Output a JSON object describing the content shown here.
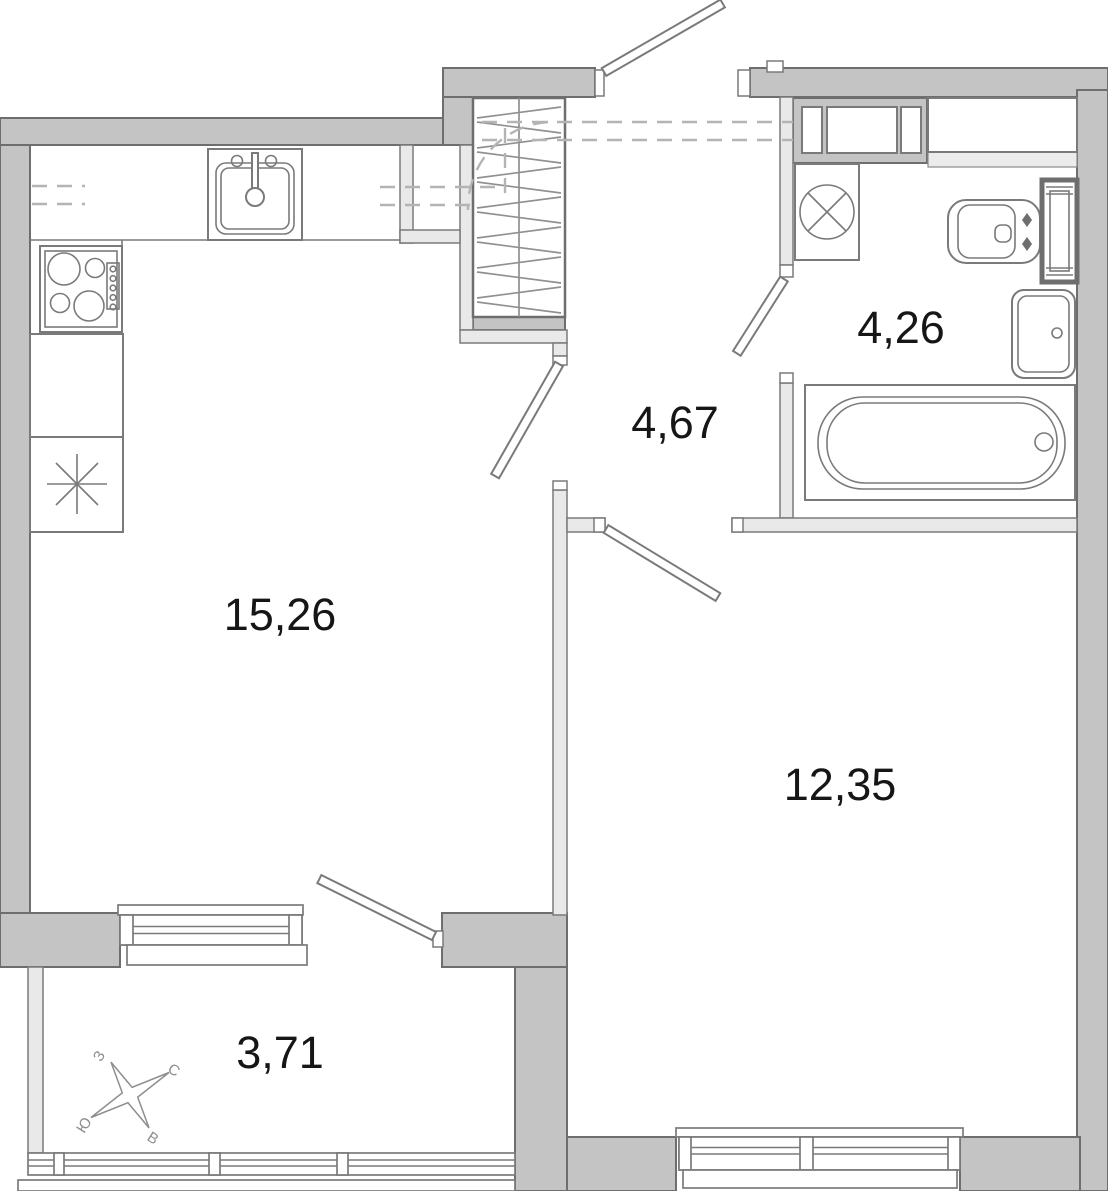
{
  "plan": {
    "rooms": [
      {
        "id": "kitchen-living-room",
        "area": "15,26"
      },
      {
        "id": "hallway",
        "area": "4,67"
      },
      {
        "id": "bathroom",
        "area": "4,26"
      },
      {
        "id": "bedroom",
        "area": "12,35"
      },
      {
        "id": "balcony",
        "area": "3,71"
      }
    ],
    "compass": {
      "north": "С",
      "south": "Ю",
      "west": "З",
      "east": "В"
    },
    "colors": {
      "wall": "#c4c4c4",
      "partition": "#e9e9e9",
      "outline": "#6e6e6e",
      "fixture_stroke": "#7a7a7a",
      "hatch": "#909090",
      "dashed": "#b4b4b4",
      "label": "#161616",
      "compass": "#8e8e8e",
      "background": "#ffffff"
    }
  }
}
